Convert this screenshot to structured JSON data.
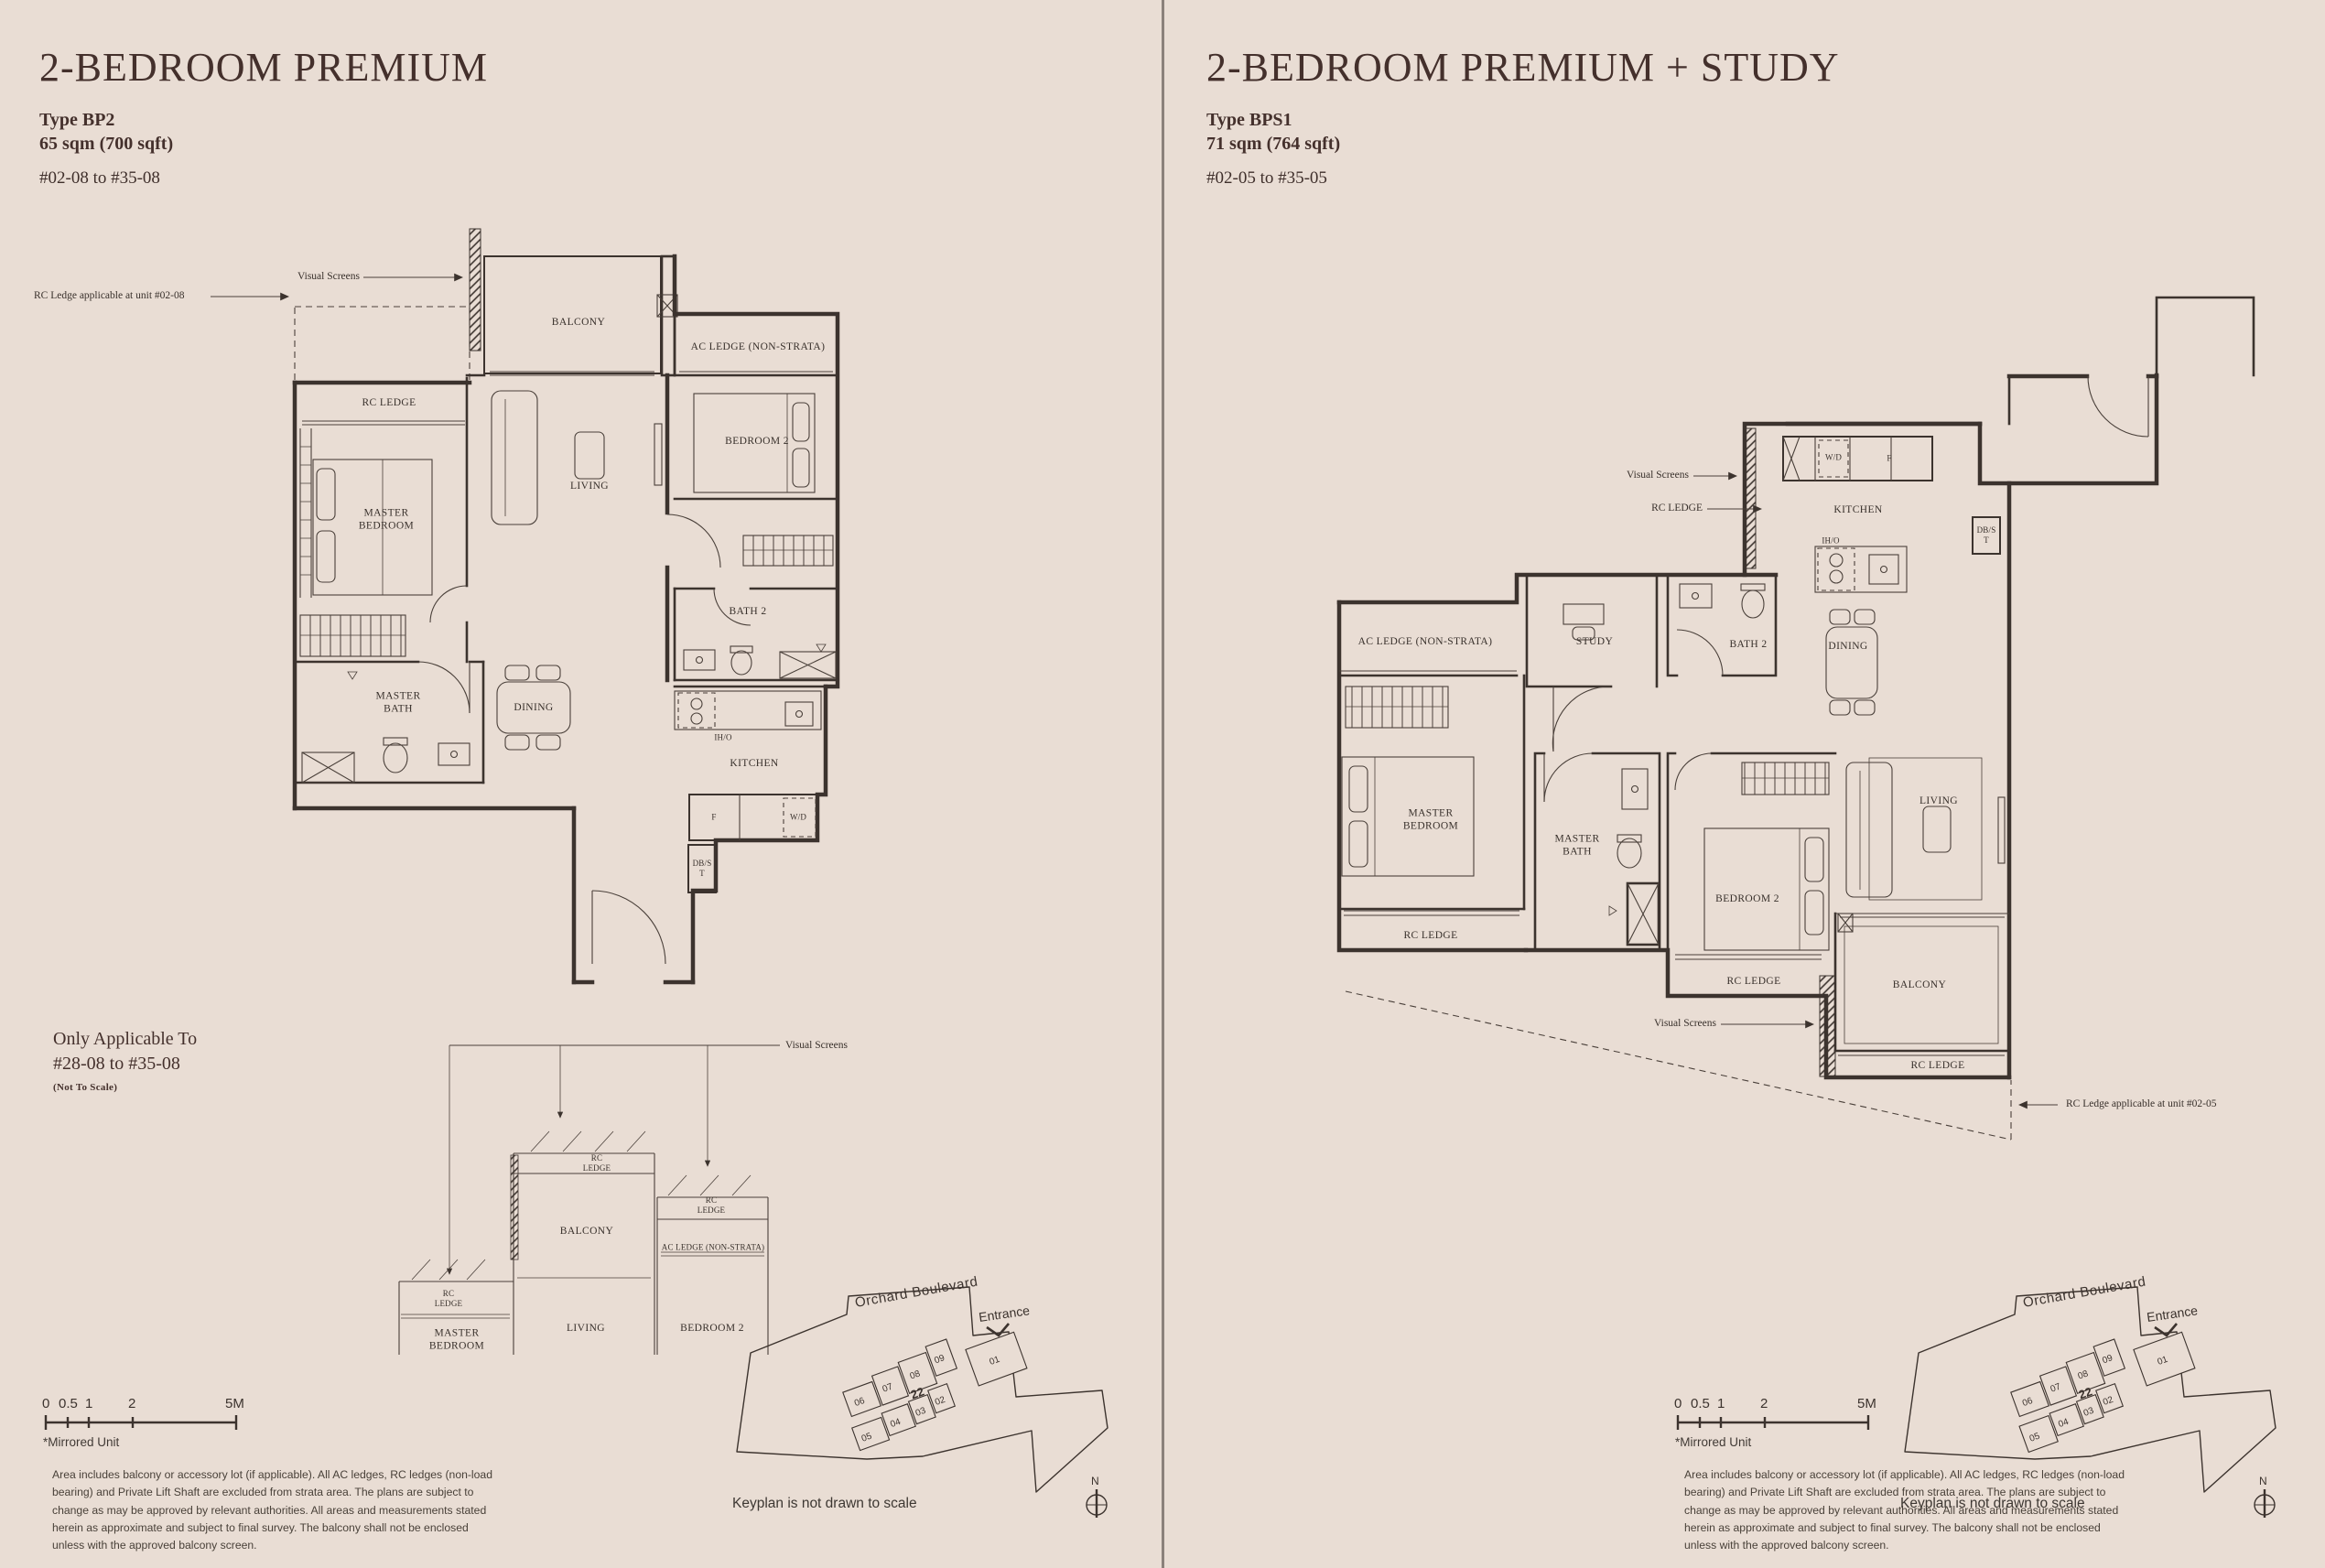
{
  "colors": {
    "background": "#e9ddd4",
    "ink": "#3c332e",
    "heading": "#44302c",
    "divider": "#8b817b",
    "keyplan_highlight_left": "#b9cec4",
    "keyplan_highlight_right": "#7e9990"
  },
  "left": {
    "title": "2-BEDROOM PREMIUM",
    "type_label": "Type BP2",
    "area_label": "65 sqm (700 sqft)",
    "units_label": "#02-08 to #35-08",
    "callouts": {
      "visual_screens": "Visual Screens",
      "rc_ledge_unit": "RC Ledge applicable at unit #02-08"
    },
    "rooms": {
      "balcony": "BALCONY",
      "ac_ledge": "AC LEDGE (NON-STRATA)",
      "rc_ledge": "RC LEDGE",
      "master_bedroom": "MASTER BEDROOM",
      "living": "LIVING",
      "bedroom_2": "BEDROOM 2",
      "bath_2": "BATH 2",
      "master_bath": "MASTER BATH",
      "dining": "DINING",
      "iho": "IH/O",
      "kitchen": "KITCHEN",
      "fridge": "F",
      "washer_dryer": "W/D",
      "db_st": "DB/ST"
    },
    "section": {
      "heading_line_1": "Only Applicable To",
      "heading_line_2": "#28-08 to #35-08",
      "note": "(Not To Scale)",
      "visual_screens": "Visual Screens",
      "rc_ledge_a": "RC LEDGE",
      "rc_ledge_b": "RC LEDGE",
      "rc_ledge_c": "RC LEDGE",
      "balcony": "BALCONY",
      "living": "LIVING",
      "ac_ledge": "AC LEDGE (NON-STRATA)",
      "master_bedroom": "MASTER BEDROOM",
      "bedroom_2": "BEDROOM 2"
    },
    "scale": {
      "t0": "0",
      "t1": "0.5",
      "t2": "1",
      "t3": "2",
      "t4": "5M"
    },
    "mirrored_note": "*Mirrored Unit",
    "disclaimer": "Area includes balcony or accessory lot (if applicable). All AC ledges, RC ledges (non-load bearing) and Private Lift Shaft are excluded from strata area. The plans are subject to change as may be approved by relevant authorities. All areas and measurements stated herein as approximate and subject to final survey. The balcony shall not be enclosed unless with the approved balcony screen.",
    "keyplan": {
      "street": "Orchard Boulevard",
      "entrance": "Entrance",
      "note": "Keyplan is not drawn to scale",
      "north": "N",
      "tower": "22",
      "units": {
        "u01": "01",
        "u02": "02",
        "u03": "03",
        "u04": "04",
        "u05": "05",
        "u06": "06",
        "u07": "07",
        "u08": "08",
        "u09": "09"
      },
      "highlighted_unit": "08"
    }
  },
  "right": {
    "title": "2-BEDROOM PREMIUM + STUDY",
    "type_label": "Type BPS1",
    "area_label": "71 sqm (764 sqft)",
    "units_label": "#02-05 to #35-05",
    "callouts": {
      "visual_screens_top": "Visual Screens",
      "rc_ledge_top": "RC LEDGE",
      "visual_screens_bottom": "Visual Screens",
      "rc_ledge_unit": "RC Ledge applicable at unit #02-05"
    },
    "rooms": {
      "washer_dryer": "W/D",
      "fridge": "F",
      "kitchen": "KITCHEN",
      "iho": "IH/O",
      "db_st": "DB/ST",
      "ac_ledge": "AC LEDGE (NON-STRATA)",
      "study": "STUDY",
      "bath_2": "BATH 2",
      "dining": "DINING",
      "master_bedroom": "MASTER BEDROOM",
      "master_bath": "MASTER BATH",
      "bedroom_2": "BEDROOM 2",
      "living": "LIVING",
      "balcony": "BALCONY",
      "rc_ledge_left": "RC LEDGE",
      "rc_ledge_mid": "RC LEDGE",
      "rc_ledge_bottom": "RC LEDGE"
    },
    "scale": {
      "t0": "0",
      "t1": "0.5",
      "t2": "1",
      "t3": "2",
      "t4": "5M"
    },
    "mirrored_note": "*Mirrored Unit",
    "disclaimer": "Area includes balcony or accessory lot (if applicable). All AC ledges, RC ledges (non-load bearing) and Private Lift Shaft are excluded from strata area. The plans are subject to change as may be approved by relevant authorities. All areas and measurements stated herein as approximate and subject to final survey. The balcony shall not be enclosed unless with the approved balcony screen.",
    "keyplan": {
      "street": "Orchard Boulevard",
      "entrance": "Entrance",
      "note": "Keyplan is not drawn to scale",
      "north": "N",
      "tower": "22",
      "units": {
        "u01": "01",
        "u02": "02",
        "u03": "03",
        "u04": "04",
        "u05": "05",
        "u06": "06",
        "u07": "07",
        "u08": "08",
        "u09": "09"
      },
      "highlighted_unit": "05"
    }
  }
}
